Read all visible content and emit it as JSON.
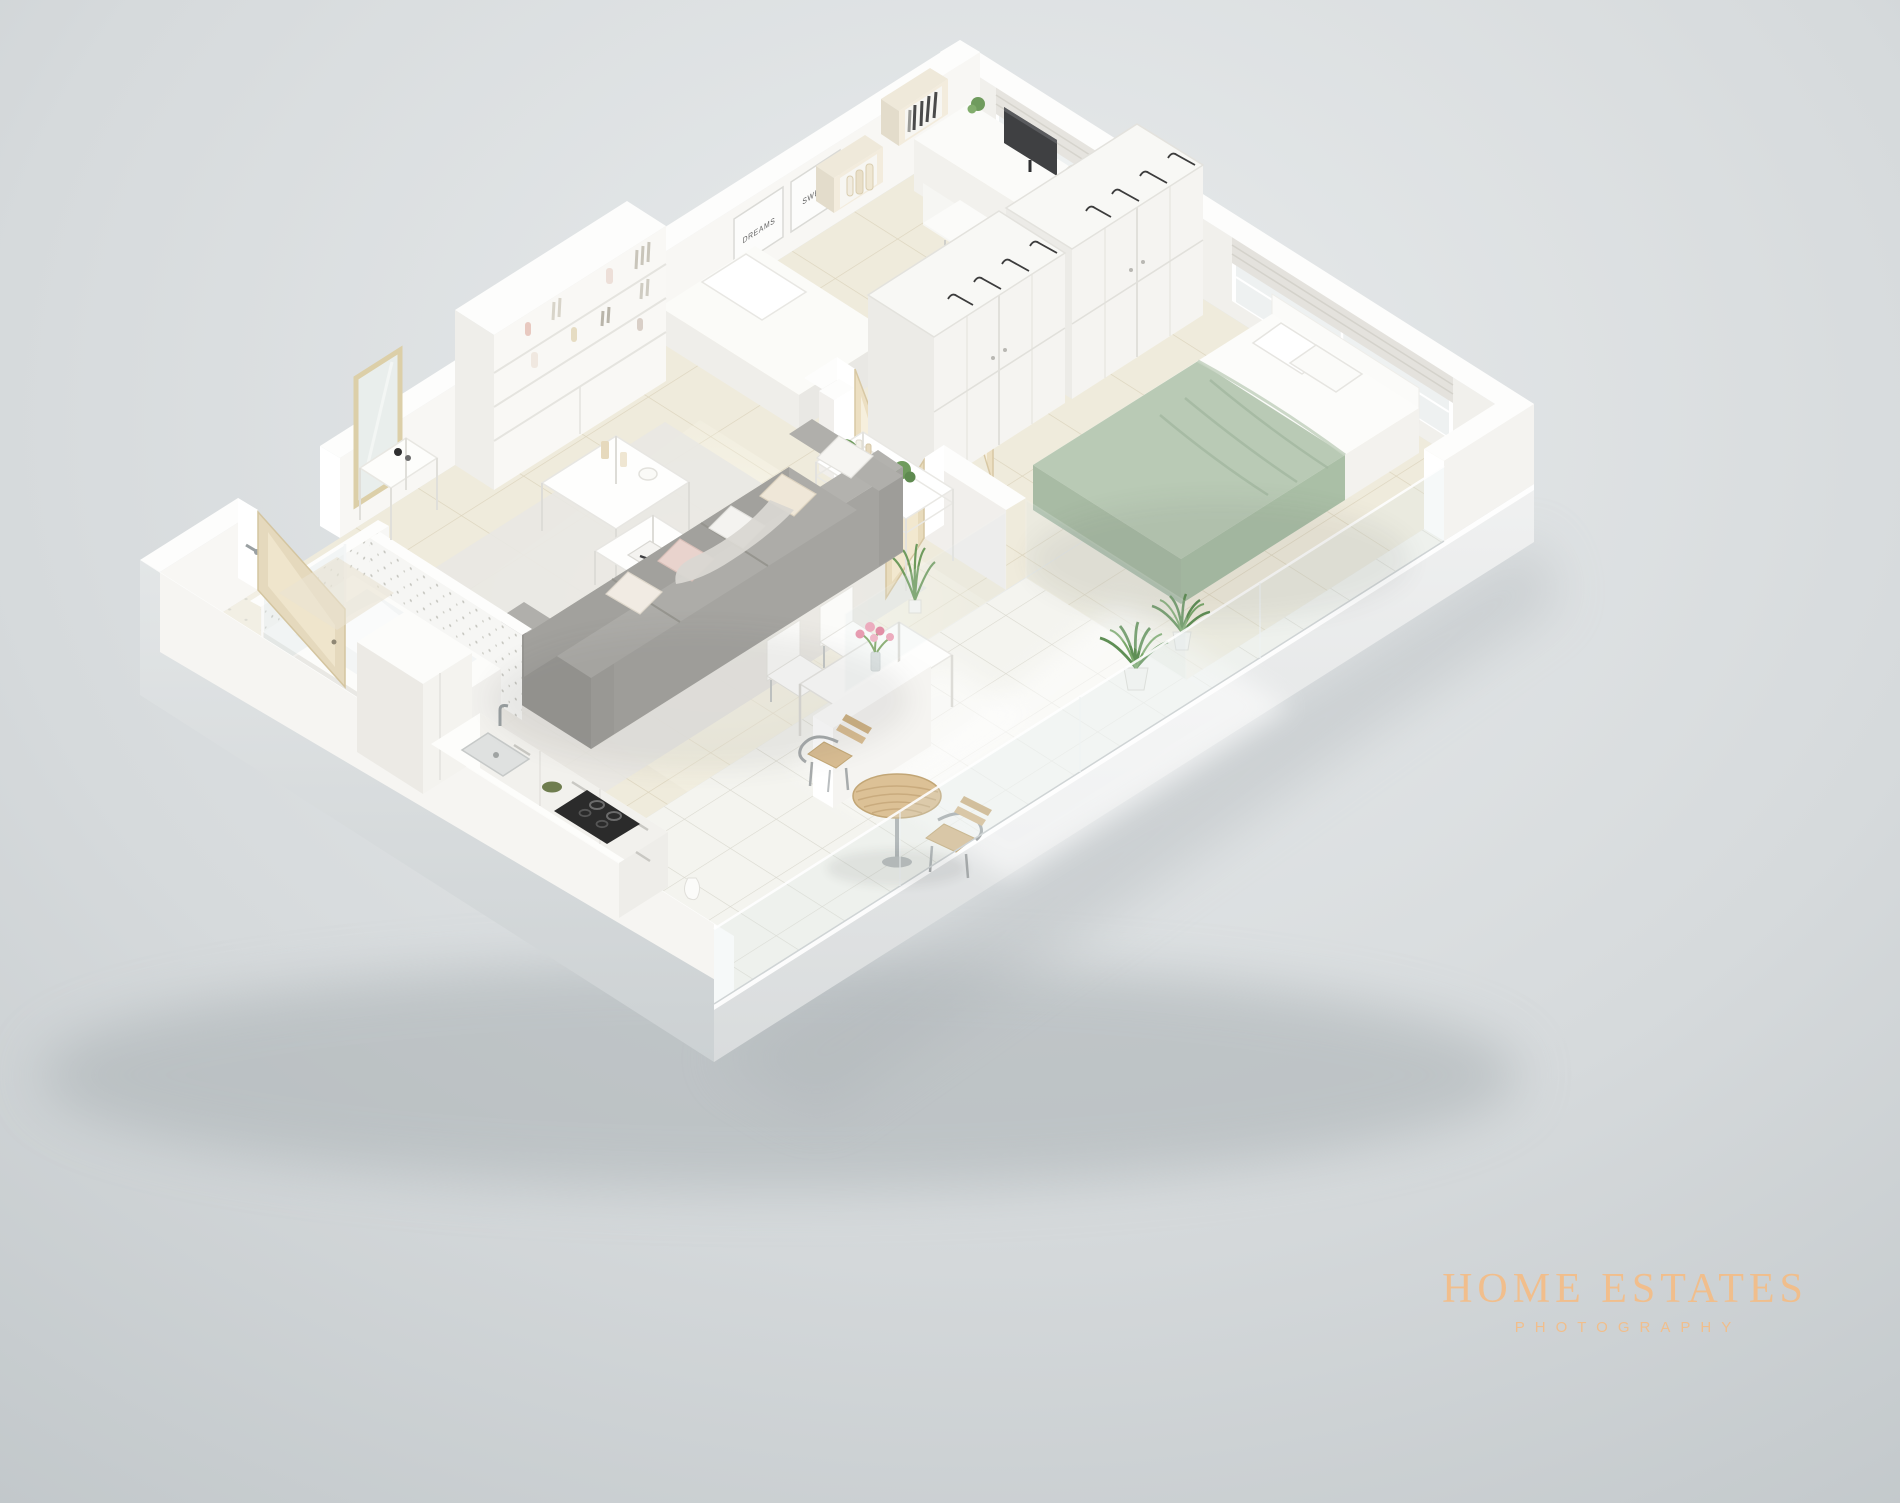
{
  "image": {
    "description": "3D isometric architectural render of a white one-bedroom apartment with cut-away walls, viewed from above",
    "style": "white minimalist 3D floor plan photography"
  },
  "watermark": {
    "line1": "HOME ESTATES",
    "line2": "PHOTOGRAPHY",
    "color": "#f4bd86"
  },
  "wall_art": {
    "poster1": "SWEET",
    "poster2": "DREAMS"
  },
  "palette": {
    "background_top": "#e8ebec",
    "background_bottom": "#c2c8cb",
    "wall_white": "#fdfdfc",
    "wall_inner_se": "#f8f7f4",
    "wall_inner_sw": "#f0efeb",
    "wall_outer_gray": "#d6d9da",
    "floor_cream": "#efebdc",
    "floor_grout": "#ddd5bf",
    "terrace_tile": "#f4f4ef",
    "terrace_grout": "#d9d8ce",
    "sofa_gray": "#a5a4a0",
    "bed_throw_green": "#b9cab5",
    "wood_light": "#e8dbbc",
    "plant_green": "#6f9b5d",
    "chrome": "#a7abac",
    "pillow_pink": "#e9d3cd"
  },
  "rooms": [
    {
      "name": "living-room",
      "furniture": [
        "bookshelf wall unit with books and vases",
        "gray fabric sofa with five pillows",
        "two white nesting coffee tables",
        "light area rug"
      ]
    },
    {
      "name": "home-office-bedroom",
      "furniture": [
        "desk with dark monitor",
        "white chair",
        "single bed",
        "two cube wall shelves",
        "SWEET and DREAMS posters",
        "window with roman blind"
      ]
    },
    {
      "name": "master-bedroom",
      "furniture": [
        "double bed with sage green throw",
        "two open-top wardrobes with hangers",
        "white shelf unit with plant",
        "large window with roman blind",
        "potted plant"
      ]
    },
    {
      "name": "kitchen",
      "furniture": [
        "white counter with sink and chrome faucet",
        "black gas cooktop",
        "tall cabinet",
        "green bowl"
      ]
    },
    {
      "name": "bathroom",
      "furniture": [
        "bathtub with speckled tile surround",
        "walk-in shower with glass panel",
        "leaning wood-framed mirror",
        "white console"
      ]
    },
    {
      "name": "hallway",
      "furniture": [
        "open wood entry door",
        "open wood bedroom door",
        "open french doors"
      ]
    },
    {
      "name": "dining-area",
      "furniture": [
        "white dining table",
        "two white chairs",
        "glass vase with pink roses"
      ]
    },
    {
      "name": "balcony",
      "furniture": [
        "round wooden bistro table",
        "two chrome chairs with wood slats",
        "glass balustrade",
        "potted plant"
      ]
    }
  ]
}
